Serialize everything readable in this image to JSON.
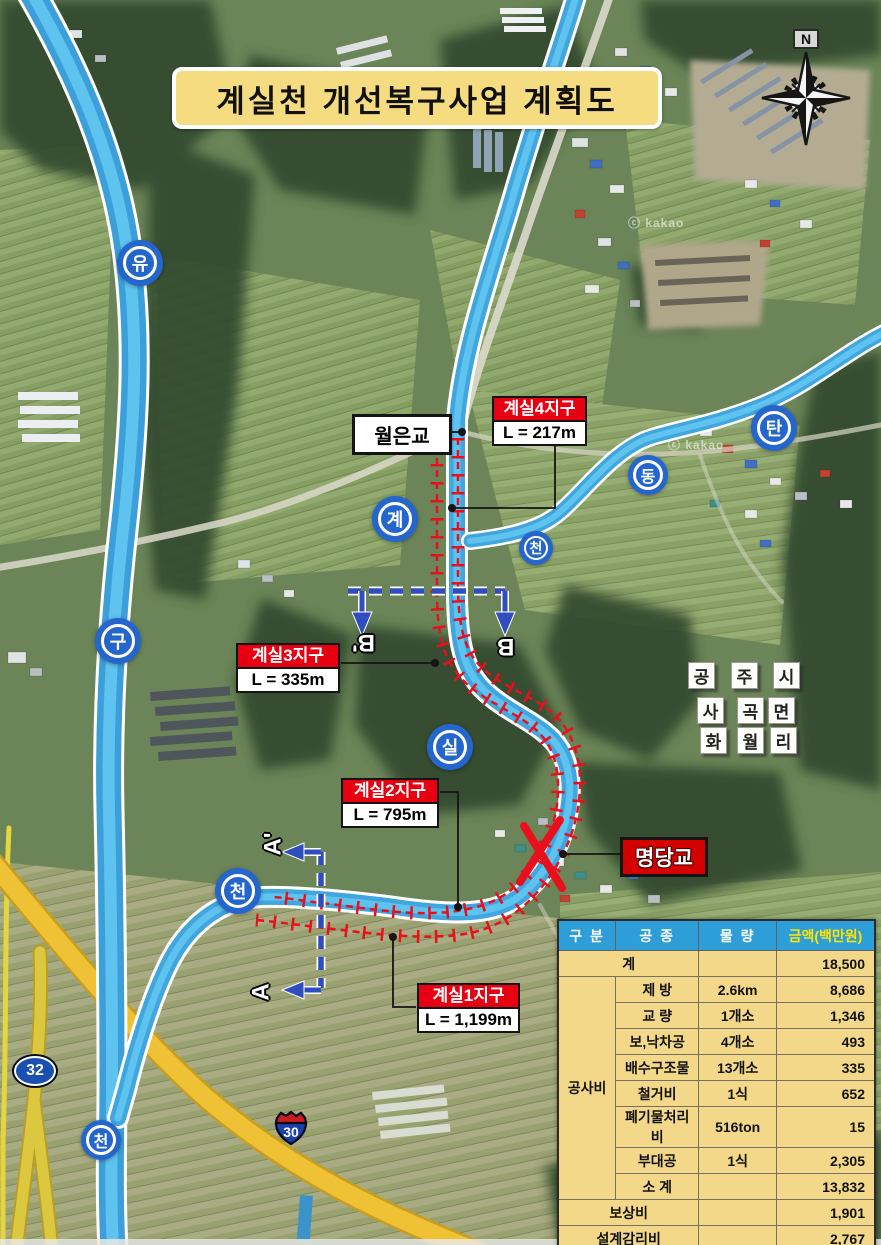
{
  "title": "계실천 개선복구사업 계획도",
  "compass": {
    "north_label": "N"
  },
  "watermark": "ⓒ kakao",
  "river_badges": {
    "yu": "유",
    "gu": "구",
    "cheon_left": "천",
    "gye": "계",
    "sil": "실",
    "cheon_mid": "천",
    "tan": "탄",
    "dong": "동",
    "cheon_right": "천"
  },
  "bridges": {
    "woleun": "월은교",
    "myeongdang": "명당교"
  },
  "districts": [
    {
      "name": "계실4지구",
      "length": "L = 217m"
    },
    {
      "name": "계실3지구",
      "length": "L = 335m"
    },
    {
      "name": "계실2지구",
      "length": "L = 795m"
    },
    {
      "name": "계실1지구",
      "length": "L = 1,199m"
    }
  ],
  "region_tiles": [
    "공",
    "주",
    "시",
    "사",
    "곡",
    "면",
    "화",
    "월",
    "리"
  ],
  "section_markers": {
    "b_prime": "B'",
    "b": "B",
    "a_prime": "A'",
    "a": "A"
  },
  "route_markers": {
    "national_32": "32",
    "national_30": "30"
  },
  "cost_table": {
    "headers": [
      "구 분",
      "공 종",
      "물 량",
      "금액(백만원)"
    ],
    "total": {
      "label": "계",
      "amount": "18,500"
    },
    "construction": {
      "label": "공사비",
      "items": [
        {
          "work": "제 방",
          "qty": "2.6km",
          "amount": "8,686"
        },
        {
          "work": "교 량",
          "qty": "1개소",
          "amount": "1,346"
        },
        {
          "work": "보,낙차공",
          "qty": "4개소",
          "amount": "493"
        },
        {
          "work": "배수구조물",
          "qty": "13개소",
          "amount": "335"
        },
        {
          "work": "철거비",
          "qty": "1식",
          "amount": "652"
        },
        {
          "work": "폐기물처리비",
          "qty": "516ton",
          "amount": "15"
        },
        {
          "work": "부대공",
          "qty": "1식",
          "amount": "2,305"
        },
        {
          "work": "소 계",
          "qty": "",
          "amount": "13,832"
        }
      ]
    },
    "compensation": {
      "label": "보상비",
      "amount": "1,901"
    },
    "design_supervision": {
      "label": "설계감리비",
      "amount": "2,767"
    }
  },
  "colors": {
    "river_blue": "#3D9FD9",
    "levee_red": "#E8101C",
    "district_red": "#E60012",
    "table_header_blue": "#2D9ED8",
    "table_body_yellow": "#F3D88A",
    "highway_yellow": "#EFC235",
    "section_blue": "#2F4DBE",
    "title_bg": "#F6DC80"
  }
}
